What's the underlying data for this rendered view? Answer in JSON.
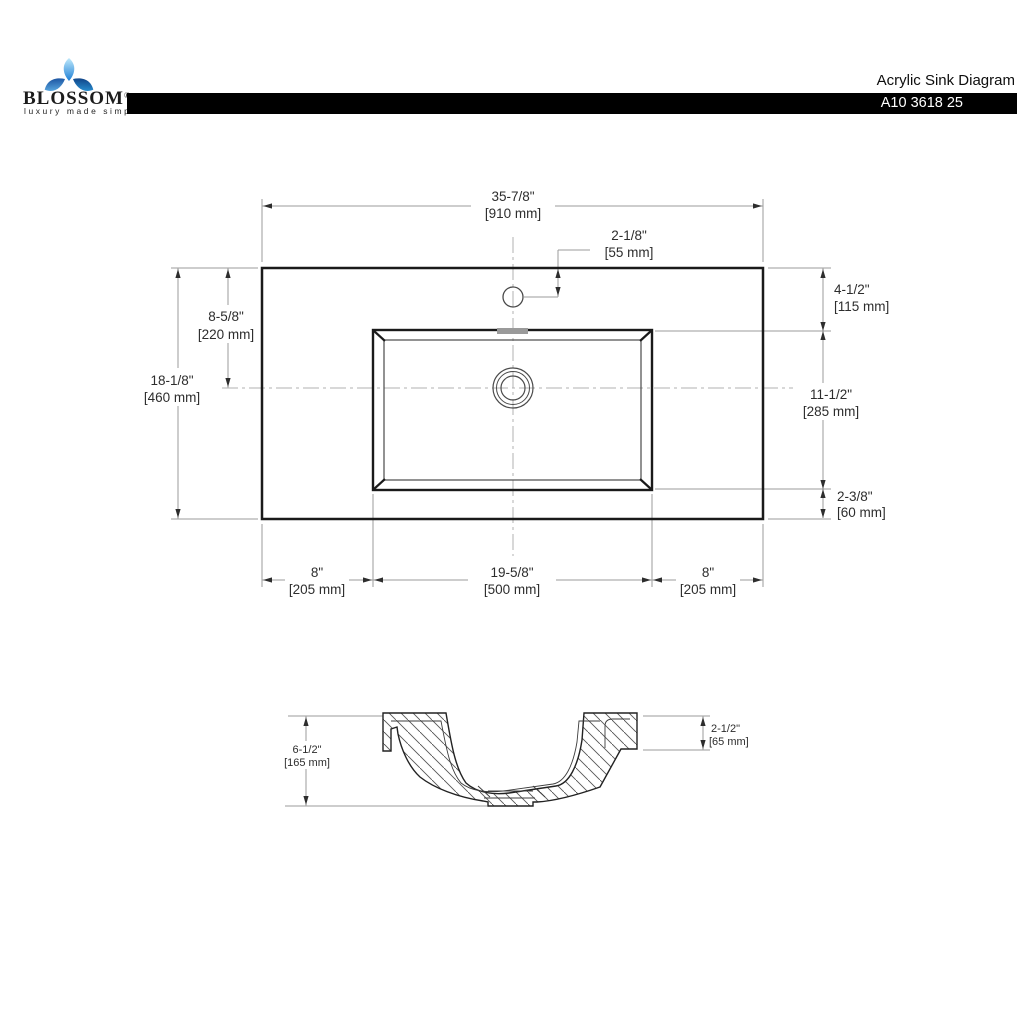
{
  "header": {
    "brand": "BLOSSOM",
    "registered": "®",
    "tagline": "luxury made simple",
    "title": "Acrylic Sink Diagram",
    "model": "A10 3618 25"
  },
  "top_view": {
    "overall_width_in": "35-7/8\"",
    "overall_width_mm": "[910 mm]",
    "faucet_offset_in": "2-1/8\"",
    "faucet_offset_mm": "[55 mm]",
    "overall_depth_in": "18-1/8\"",
    "overall_depth_mm": "[460 mm]",
    "center_from_back_in": "8-5/8\"",
    "center_from_back_mm": "[220 mm]",
    "basin_from_back_in": "4-1/2\"",
    "basin_from_back_mm": "[115 mm]",
    "basin_depth_in": "11-1/2\"",
    "basin_depth_mm": "[285 mm]",
    "basin_to_front_in": "2-3/8\"",
    "basin_to_front_mm": "[60 mm]",
    "left_margin_in": "8\"",
    "left_margin_mm": "[205 mm]",
    "basin_width_in": "19-5/8\"",
    "basin_width_mm": "[500 mm]",
    "right_margin_in": "8\"",
    "right_margin_mm": "[205 mm]"
  },
  "section_view": {
    "overall_height_in": "6-1/2\"",
    "overall_height_mm": "[165 mm]",
    "rim_height_in": "2-1/2\"",
    "rim_height_mm": "[65 mm]"
  },
  "colors": {
    "outline": "#1a1a1a",
    "dim": "#9b9b9b",
    "center": "#b0b0b0",
    "arrow": "#2d2d2d",
    "text": "#2d2d2d",
    "bar": "#000000",
    "logo_blue_light": "#8ed8f5",
    "logo_blue_dark": "#0d47a1"
  }
}
